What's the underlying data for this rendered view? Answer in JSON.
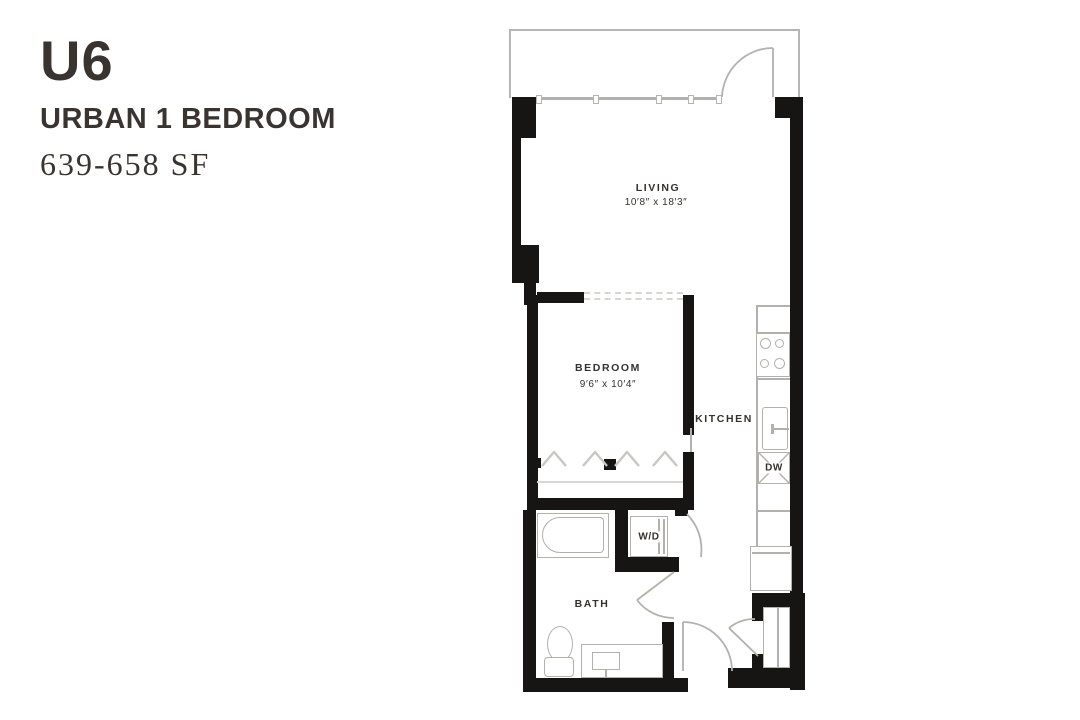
{
  "info_panel": {
    "unit_code": "U6",
    "unit_type": "URBAN 1 BEDROOM",
    "square_footage": "639-658 SF"
  },
  "floor_plan": {
    "rooms": {
      "living": {
        "label": "LIVING",
        "dimensions": "10′8″ x 18′3″"
      },
      "bedroom": {
        "label": "BEDROOM",
        "dimensions": "9′6″ x 10′4″"
      },
      "kitchen": {
        "label": "KITCHEN"
      },
      "bath": {
        "label": "BATH"
      }
    },
    "appliances": {
      "washer_dryer": "W/D",
      "dishwasher": "DW"
    },
    "colors": {
      "wall": "#171513",
      "fixture_line": "#b3b1ae",
      "text": "#35312e"
    }
  }
}
